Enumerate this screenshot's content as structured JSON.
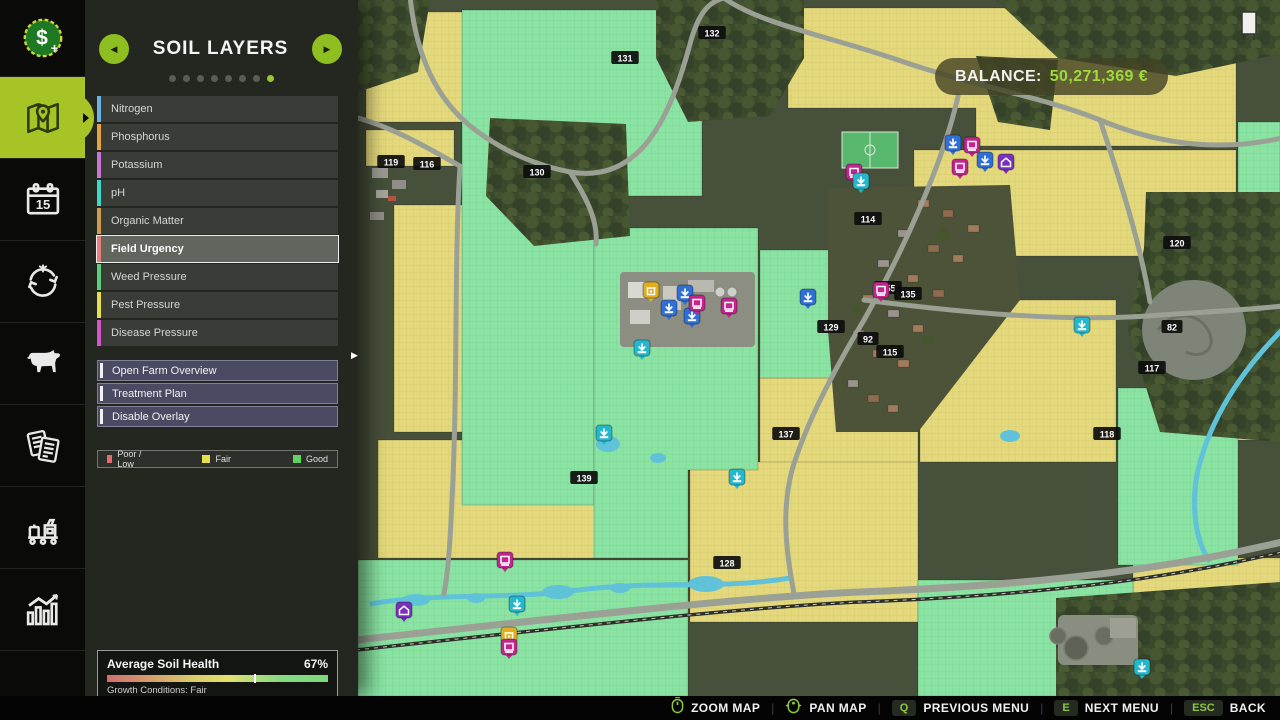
{
  "sidebar": {
    "items": [
      {
        "icon": "money-icon",
        "name": "finances",
        "active": false
      },
      {
        "icon": "map-icon",
        "name": "map",
        "active": true
      },
      {
        "icon": "calendar-icon",
        "name": "calendar",
        "active": false
      },
      {
        "icon": "crop-rotation-icon",
        "name": "crop-rotation",
        "active": false
      },
      {
        "icon": "animals-icon",
        "name": "animals",
        "active": false
      },
      {
        "icon": "contracts-icon",
        "name": "contracts",
        "active": false
      },
      {
        "icon": "production-icon",
        "name": "production",
        "active": false
      },
      {
        "icon": "statistics-icon",
        "name": "statistics",
        "active": false
      },
      {
        "icon": "partial-icon",
        "name": "more",
        "active": false
      }
    ]
  },
  "panel": {
    "title": "SOIL LAYERS",
    "pager": {
      "dots": 8,
      "active_dot": 8
    },
    "layers": [
      {
        "label": "Nitrogen",
        "color": "#6cb3e6",
        "selected": false
      },
      {
        "label": "Phosphorus",
        "color": "#e8a33e",
        "selected": false
      },
      {
        "label": "Potassium",
        "color": "#c976d6",
        "selected": false
      },
      {
        "label": "pH",
        "color": "#3ed8c8",
        "selected": false
      },
      {
        "label": "Organic Matter",
        "color": "#cf9b4d",
        "selected": false
      },
      {
        "label": "Field Urgency",
        "color": "#e87f7f",
        "selected": true
      },
      {
        "label": "Weed Pressure",
        "color": "#5fd07a",
        "selected": false
      },
      {
        "label": "Pest Pressure",
        "color": "#e6e04e",
        "selected": false
      },
      {
        "label": "Disease Pressure",
        "color": "#d356c8",
        "selected": false
      }
    ],
    "actions": [
      {
        "label": "Open Farm Overview"
      },
      {
        "label": "Treatment Plan"
      },
      {
        "label": "Disable Overlay"
      }
    ],
    "legend": [
      {
        "label": "Poor / Low",
        "color": "#e06c6c"
      },
      {
        "label": "Fair",
        "color": "#e6e04e"
      },
      {
        "label": "Good",
        "color": "#62d35e"
      }
    ],
    "soil_health": {
      "title": "Average Soil Health",
      "value": "67%",
      "percent": 67,
      "subtitle": "Growth Conditions: Fair"
    }
  },
  "map": {
    "balance": {
      "label": "BALANCE:",
      "value": "50,271,369 €"
    },
    "field_badges": [
      {
        "label": "132",
        "x": 354,
        "y": 33
      },
      {
        "label": "131",
        "x": 267,
        "y": 58
      },
      {
        "label": "119",
        "x": 33,
        "y": 162
      },
      {
        "label": "116",
        "x": 69,
        "y": 164
      },
      {
        "label": "130",
        "x": 179,
        "y": 172
      },
      {
        "label": "114",
        "x": 510,
        "y": 219
      },
      {
        "label": "120",
        "x": 819,
        "y": 243
      },
      {
        "label": "255",
        "x": 530,
        "y": 288
      },
      {
        "label": "135",
        "x": 550,
        "y": 294
      },
      {
        "label": "129",
        "x": 473,
        "y": 327
      },
      {
        "label": "92",
        "x": 510,
        "y": 339
      },
      {
        "label": "115",
        "x": 532,
        "y": 352
      },
      {
        "label": "82",
        "x": 814,
        "y": 327
      },
      {
        "label": "117",
        "x": 794,
        "y": 368
      },
      {
        "label": "137",
        "x": 428,
        "y": 434
      },
      {
        "label": "118",
        "x": 749,
        "y": 434
      },
      {
        "label": "139",
        "x": 226,
        "y": 478
      },
      {
        "label": "128",
        "x": 369,
        "y": 563
      }
    ],
    "poi_markers": [
      {
        "x": 293,
        "y": 291,
        "color": "#dfae22",
        "kind": "shop"
      },
      {
        "x": 327,
        "y": 294,
        "color": "#2f6fd6",
        "kind": "storage"
      },
      {
        "x": 311,
        "y": 309,
        "color": "#2f6fd6",
        "kind": "storage"
      },
      {
        "x": 334,
        "y": 317,
        "color": "#2f6fd6",
        "kind": "storage"
      },
      {
        "x": 339,
        "y": 304,
        "color": "#c0268e",
        "kind": "machine"
      },
      {
        "x": 371,
        "y": 307,
        "color": "#c0268e",
        "kind": "machine"
      },
      {
        "x": 284,
        "y": 349,
        "color": "#25b8cc",
        "kind": "storage"
      },
      {
        "x": 595,
        "y": 144,
        "color": "#2f6fd6",
        "kind": "storage"
      },
      {
        "x": 614,
        "y": 146,
        "color": "#c0268e",
        "kind": "machine"
      },
      {
        "x": 602,
        "y": 168,
        "color": "#c0268e",
        "kind": "machine"
      },
      {
        "x": 627,
        "y": 161,
        "color": "#2f6fd6",
        "kind": "storage"
      },
      {
        "x": 648,
        "y": 163,
        "color": "#7b2fc0",
        "kind": "building"
      },
      {
        "x": 496,
        "y": 173,
        "color": "#c0268e",
        "kind": "machine"
      },
      {
        "x": 503,
        "y": 182,
        "color": "#25b8cc",
        "kind": "storage"
      },
      {
        "x": 523,
        "y": 291,
        "color": "#c0268e",
        "kind": "machine"
      },
      {
        "x": 450,
        "y": 298,
        "color": "#2f6fd6",
        "kind": "storage"
      },
      {
        "x": 724,
        "y": 326,
        "color": "#25b8cc",
        "kind": "storage"
      },
      {
        "x": 246,
        "y": 434,
        "color": "#25b8cc",
        "kind": "storage"
      },
      {
        "x": 379,
        "y": 478,
        "color": "#25b8cc",
        "kind": "storage"
      },
      {
        "x": 46,
        "y": 611,
        "color": "#7b2fc0",
        "kind": "building"
      },
      {
        "x": 147,
        "y": 561,
        "color": "#c0268e",
        "kind": "machine"
      },
      {
        "x": 159,
        "y": 605,
        "color": "#25b8cc",
        "kind": "storage"
      },
      {
        "x": 151,
        "y": 636,
        "color": "#dfae22",
        "kind": "shop"
      },
      {
        "x": 151,
        "y": 648,
        "color": "#c0268e",
        "kind": "machine"
      },
      {
        "x": 784,
        "y": 668,
        "color": "#25b8cc",
        "kind": "storage"
      }
    ]
  },
  "bottom_bar": {
    "hints": [
      {
        "icon": "mouse-zoom-icon",
        "label": "ZOOM MAP"
      },
      {
        "icon": "mouse-pan-icon",
        "label": "PAN MAP"
      },
      {
        "key": "Q",
        "label": "PREVIOUS MENU"
      },
      {
        "key": "E",
        "label": "NEXT MENU"
      },
      {
        "key": "ESC",
        "label": "BACK"
      }
    ]
  },
  "colors": {
    "accent": "#a6c426",
    "key_green": "#8dc63f",
    "balance_green": "#9ddb3a",
    "field_fair": "#e4d87c",
    "field_good": "#8ae3a3"
  }
}
